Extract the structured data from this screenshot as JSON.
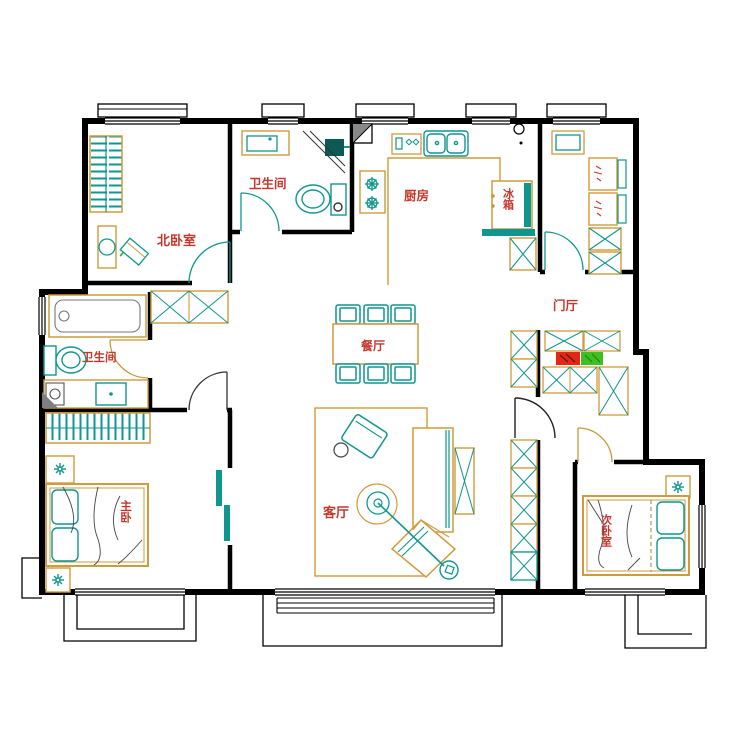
{
  "drawing": {
    "type": "apartment-floor-plan",
    "style": "CAD line drawing"
  },
  "colors": {
    "wall": "#000000",
    "furniture_outline": "#cf9b3c",
    "fixture_teal": "#0f9690",
    "label_red": "#c5372c",
    "shoe_box_red": "#e62517",
    "shoe_box_green": "#3ec025",
    "background": "#ffffff"
  },
  "rooms": [
    {
      "id": "north-bedroom",
      "label": "北卧室"
    },
    {
      "id": "bathroom-north",
      "label": "卫生间"
    },
    {
      "id": "kitchen",
      "label": "厨房"
    },
    {
      "id": "entry-hall",
      "label": "门厅"
    },
    {
      "id": "bathroom-west",
      "label": "卫生间"
    },
    {
      "id": "dining-room",
      "label": "餐厅"
    },
    {
      "id": "living-room",
      "label": "客厅"
    },
    {
      "id": "master-bedroom",
      "label": "主卧"
    },
    {
      "id": "second-bedroom",
      "label": "次卧室"
    }
  ],
  "appliances": [
    {
      "id": "fridge",
      "label": "冰箱"
    }
  ]
}
